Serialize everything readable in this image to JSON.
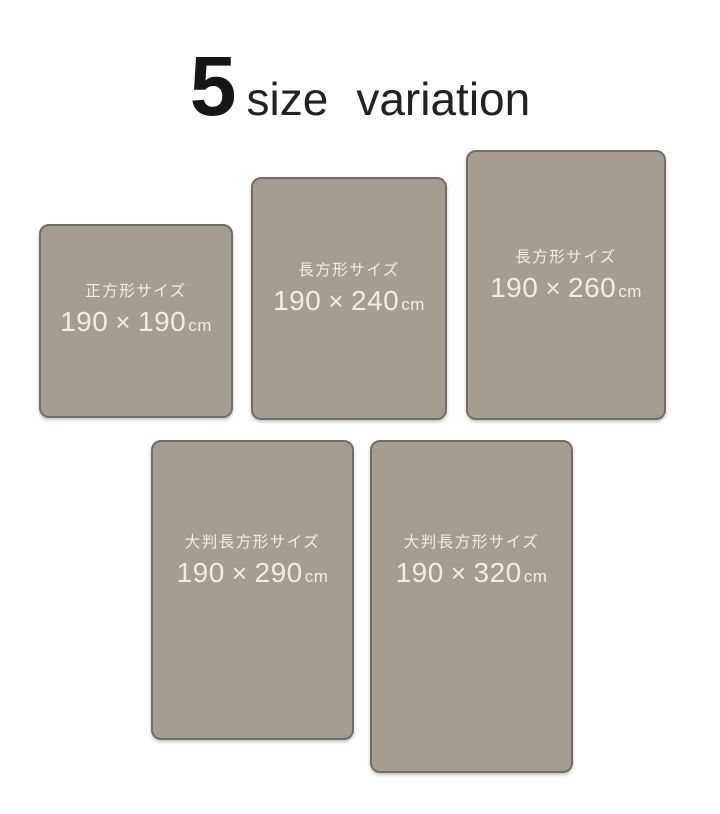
{
  "title": {
    "number": "5",
    "words": [
      "size",
      "variation"
    ]
  },
  "cards": [
    {
      "label": "正方形サイズ",
      "width_cm": "190",
      "separator": "×",
      "height_cm": "190",
      "unit": "cm"
    },
    {
      "label": "長方形サイズ",
      "width_cm": "190",
      "separator": "×",
      "height_cm": "240",
      "unit": "cm"
    },
    {
      "label": "長方形サイズ",
      "width_cm": "190",
      "separator": "×",
      "height_cm": "260",
      "unit": "cm"
    },
    {
      "label": "大判長方形サイズ",
      "width_cm": "190",
      "separator": "×",
      "height_cm": "290",
      "unit": "cm"
    },
    {
      "label": "大判長方形サイズ",
      "width_cm": "190",
      "separator": "×",
      "height_cm": "320",
      "unit": "cm"
    }
  ],
  "colors": {
    "background": "#ffffff",
    "card_fill": "#a69d91",
    "card_border": "#716e66",
    "card_text": "#f1ece3",
    "title_text": "#161616"
  }
}
